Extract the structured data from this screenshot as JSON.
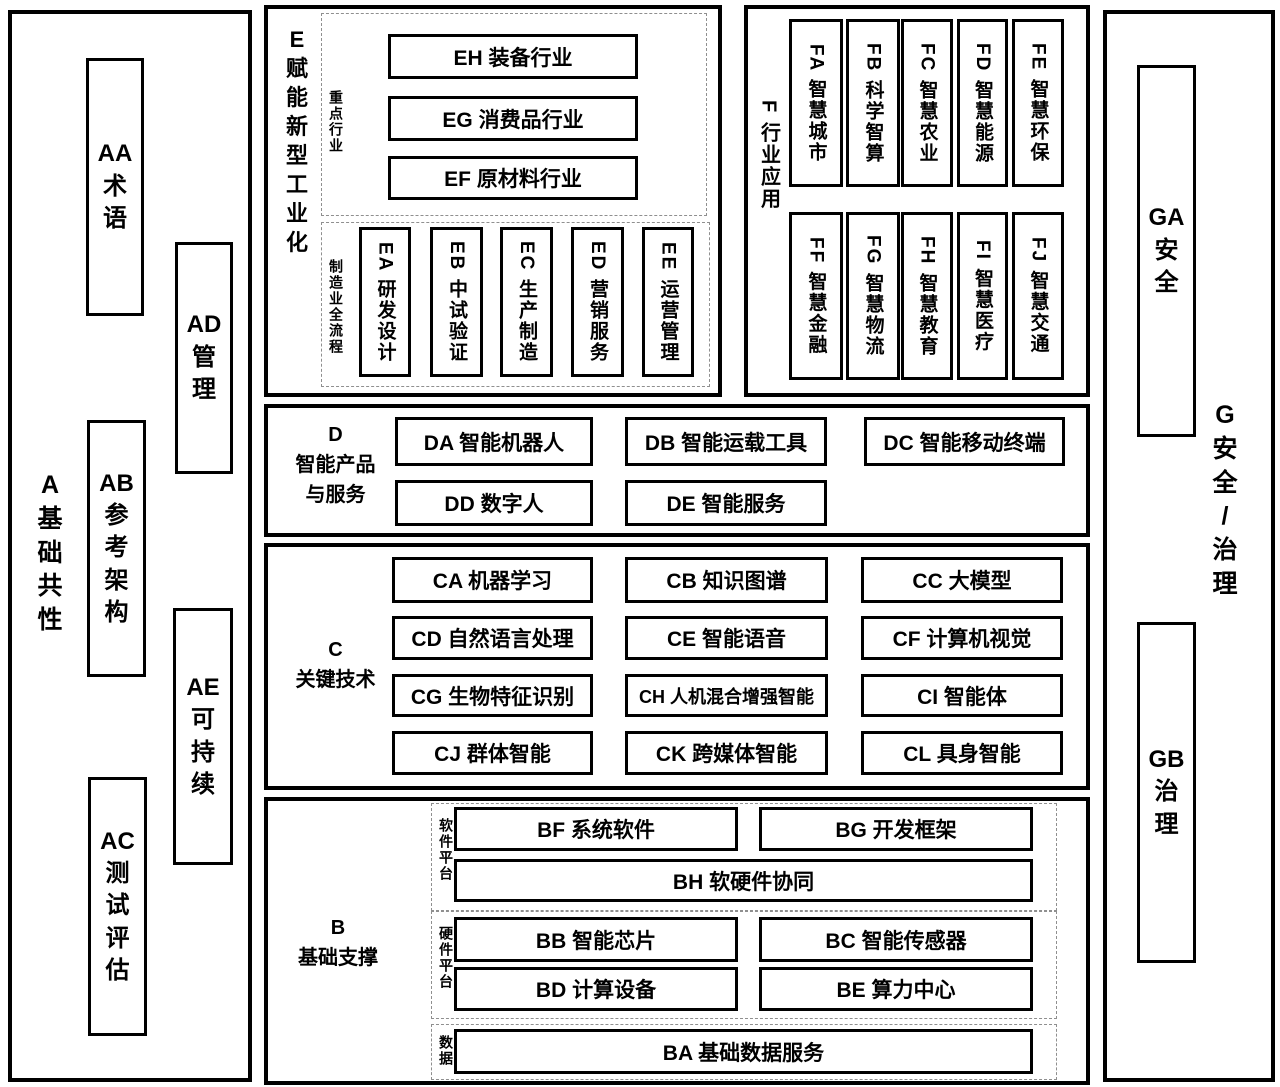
{
  "colors": {
    "border": "#000000",
    "background": "#ffffff",
    "text": "#000000",
    "dashed_border": "#8f8f8f"
  },
  "section_a": {
    "label_lines": [
      "A",
      "基",
      "础",
      "共",
      "性"
    ],
    "items": [
      {
        "label_lines": [
          "AA",
          "术",
          "语"
        ]
      },
      {
        "label_lines": [
          "AD",
          "管",
          "理"
        ]
      },
      {
        "label_lines": [
          "AB",
          "参",
          "考",
          "架",
          "构"
        ]
      },
      {
        "label_lines": [
          "AE",
          "可",
          "持",
          "续"
        ]
      },
      {
        "label_lines": [
          "AC",
          "测",
          "试",
          "评",
          "估"
        ]
      }
    ]
  },
  "section_e": {
    "label_lines": [
      "E",
      "赋",
      "能",
      "新",
      "型",
      "工",
      "业",
      "化"
    ],
    "key_industries": {
      "group_label": "重点行业",
      "items": [
        "EH 装备行业",
        "EG 消费品行业",
        "EF 原材料行业"
      ]
    },
    "manufacturing_chain": {
      "group_label": "制造业全流程",
      "items": [
        "EA 研发设计",
        "EB 中试验证",
        "EC 生产制造",
        "ED 营销服务",
        "EE 运营管理"
      ]
    }
  },
  "section_f": {
    "label": "F 行业应用",
    "row1": [
      "FA 智慧城市",
      "FB 科学智算",
      "FC 智慧农业",
      "FD 智慧能源",
      "FE 智慧环保"
    ],
    "row2": [
      "FF 智慧金融",
      "FG 智慧物流",
      "FH 智慧教育",
      "FI 智慧医疗",
      "FJ 智慧交通"
    ]
  },
  "section_d": {
    "label_lines": [
      "D",
      "智能产品",
      "与服务"
    ],
    "row1": [
      "DA 智能机器人",
      "DB 智能运载工具",
      "DC 智能移动终端"
    ],
    "row2": [
      "DD 数字人",
      "DE 智能服务"
    ]
  },
  "section_c": {
    "label_lines": [
      "C",
      "关键技术"
    ],
    "rows": [
      [
        "CA 机器学习",
        "CB 知识图谱",
        "CC 大模型"
      ],
      [
        "CD 自然语言处理",
        "CE 智能语音",
        "CF 计算机视觉"
      ],
      [
        "CG 生物特征识别",
        "CH 人机混合增强智能",
        "CI 智能体"
      ],
      [
        "CJ 群体智能",
        "CK 跨媒体智能",
        "CL 具身智能"
      ]
    ]
  },
  "section_b": {
    "label_lines": [
      "B",
      "基础支撑"
    ],
    "software_platform": {
      "group_label": "软件平台",
      "row1": [
        "BF 系统软件",
        "BG 开发框架"
      ],
      "row2_full": "BH 软硬件协同"
    },
    "hardware_platform": {
      "group_label": "硬件平台",
      "row1": [
        "BB 智能芯片",
        "BC 智能传感器"
      ],
      "row2": [
        "BD 计算设备",
        "BE 算力中心"
      ]
    },
    "data_layer": {
      "group_label": "数据",
      "full": "BA 基础数据服务"
    }
  },
  "section_g": {
    "label_lines": [
      "G",
      "安",
      "全",
      "/",
      "治",
      "理"
    ],
    "items": [
      {
        "label_lines": [
          "GA",
          "安",
          "全"
        ]
      },
      {
        "label_lines": [
          "GB",
          "治",
          "理"
        ]
      }
    ]
  }
}
